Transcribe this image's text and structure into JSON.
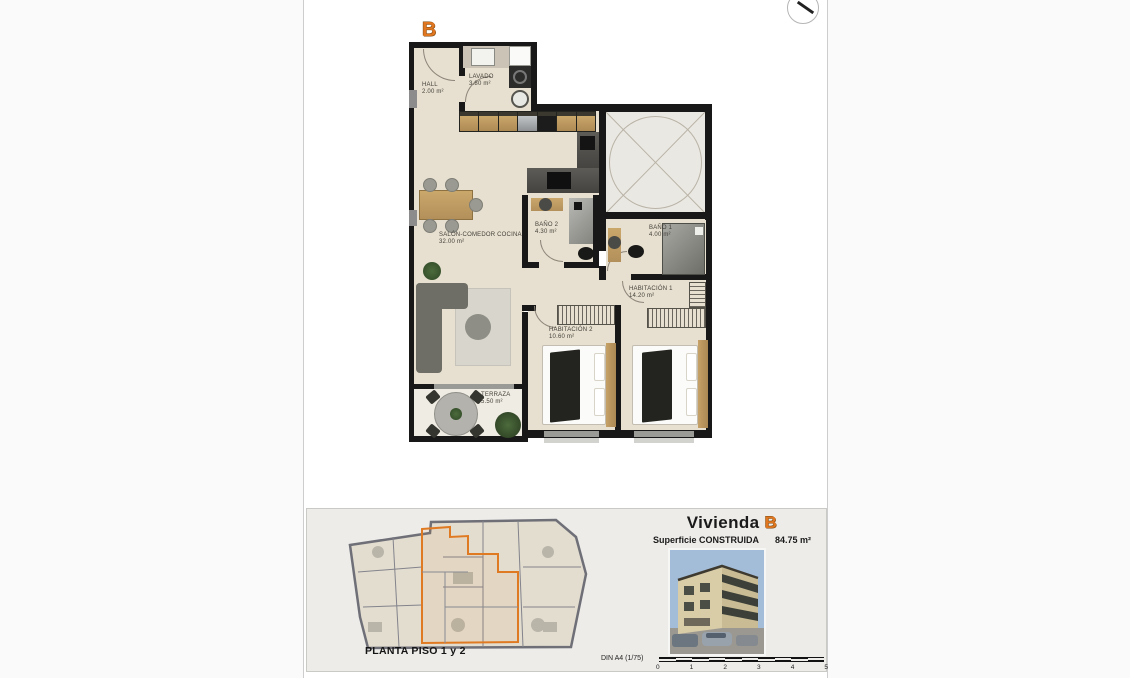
{
  "plan": {
    "unit_marker": "B",
    "rooms": [
      {
        "name": "HALL",
        "area": "2.00 m²"
      },
      {
        "name": "LAVADO",
        "area": "3.80 m²"
      },
      {
        "name": "SALÓN-COMEDOR COCINA",
        "area": "32.00 m²"
      },
      {
        "name": "BAÑO 2",
        "area": "4.30 m²"
      },
      {
        "name": "BAÑO 1",
        "area": "4.00 m²"
      },
      {
        "name": "HABITACIÓN 1",
        "area": "14.20 m²"
      },
      {
        "name": "HABITACIÓN 2",
        "area": "10.60 m²"
      },
      {
        "name": "TERRAZA",
        "area": "5.50 m²"
      }
    ]
  },
  "footer": {
    "site_plan_caption": "PLANTA PISO 1 y 2",
    "unit_title_prefix": "Vivienda",
    "unit_title_letter": "B",
    "surface_label": "Superficie CONSTRUIDA",
    "surface_value": "84.75 m²",
    "scale_label": "DIN A4 (1/75)",
    "scale_ticks": [
      "0",
      "1",
      "2",
      "3",
      "4",
      "5"
    ]
  },
  "colors": {
    "accent_orange": "#e0761f",
    "wall_black": "#181818",
    "floor_beige": "#e7e0d0"
  }
}
